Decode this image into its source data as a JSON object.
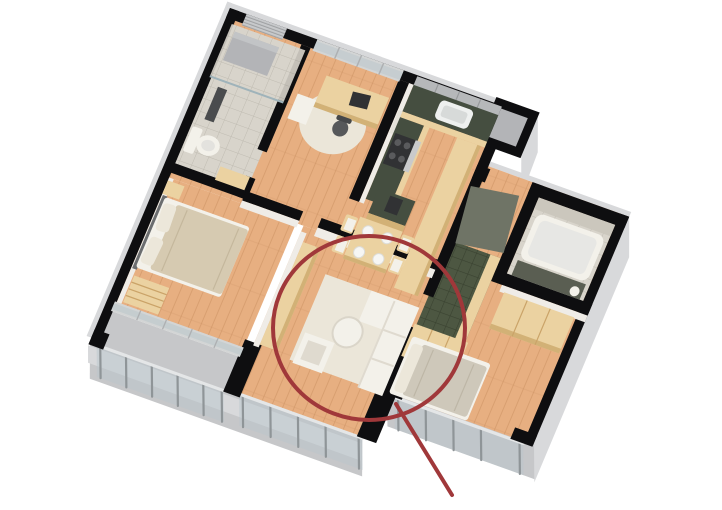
{
  "meta": {
    "kind": "3d-apartment-floor-plan-render",
    "background": "#ffffff",
    "canvas": {
      "width": 722,
      "height": 510
    },
    "view": "axonometric top-down cutaway, plan rotated about 21 degrees"
  },
  "colors": {
    "wall_black": "#0e0e10",
    "wall_face_light": "#efece7",
    "outer_gray": "#c6c7c9",
    "outer_gray_light": "#d8d9db",
    "outer_gray_dark": "#b3b4b7",
    "floor_wood": "#e7af81",
    "floor_wood_line": "#c9905f",
    "furn_wood": "#ebd2a1",
    "furn_wood_dark": "#d2b176",
    "counter_green": "#454e40",
    "tile_green": "#4d5742",
    "tile_green_line": "#3a4230",
    "bath_tile": "#d8d4cb",
    "bath_tile_dark": "#cbc7bd",
    "white_furn": "#f3f1ea",
    "white_furn_shadow": "#dfdacf",
    "rug": "#ebe6d9",
    "duvet": "#d6cab1",
    "pillow": "#ece7da",
    "glass": "#b9c6cb",
    "glass_frame": "#d3d5d5",
    "rail_post": "#8f9598",
    "door_gray": "#6f7466",
    "appliance_dark": "#313234",
    "annotation_red": "#a0383a"
  },
  "annotation": {
    "shape": "ellipse",
    "target": "living-room-sofa-area",
    "cx": 369,
    "cy": 328,
    "rx": 96,
    "ry": 92,
    "stroke_width": 4,
    "leader_line": {
      "x1": 396,
      "y1": 404,
      "x2": 452,
      "y2": 495,
      "width": 4
    }
  },
  "scene": {
    "rooms": [
      {
        "name": "bathroom-1",
        "furniture": [
          "toilet",
          "shower-column",
          "washer-unit",
          "wood-cabinet",
          "louver-window"
        ]
      },
      {
        "name": "office",
        "furniture": [
          "desk",
          "laptop",
          "office-chair",
          "round-rug",
          "white-drawer-unit",
          "window-band"
        ]
      },
      {
        "name": "kitchen-dining",
        "furniture": [
          "l-shaped-green-counter",
          "sink",
          "stove",
          "upper-cabinets",
          "island-with-coffee-machine",
          "dining-table",
          "four-plates",
          "four-chairs",
          "bar-counter"
        ]
      },
      {
        "name": "master-bedroom",
        "furniture": [
          "double-bed",
          "two-pillows",
          "nightstand",
          "closet-nook-shelves",
          "window-wall"
        ]
      },
      {
        "name": "living-room",
        "furniture": [
          "sectional-sofa",
          "round-ottoman",
          "armchair",
          "white-rug",
          "long-sideboard"
        ]
      },
      {
        "name": "entry-hall",
        "furniture": [
          "green-tile-floor",
          "pivot-door-panel",
          "wardrobe-cabinets"
        ]
      },
      {
        "name": "bathroom-2",
        "furniture": [
          "bathtub",
          "tile-walls",
          "vase"
        ]
      },
      {
        "name": "bedroom-2",
        "furniture": [
          "single-bed",
          "wardrobe-3-door",
          "side-cabinet",
          "glass-rail"
        ]
      },
      {
        "name": "balcony",
        "furniture": [
          "glass-railing",
          "concrete-slab"
        ]
      }
    ]
  }
}
